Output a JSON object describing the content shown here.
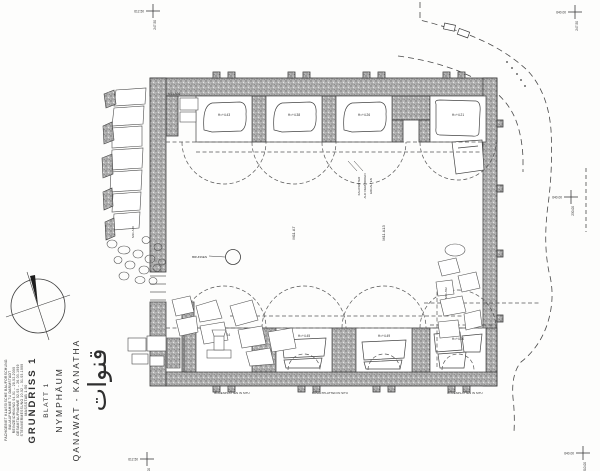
{
  "sheet": {
    "title_ar": "قنوات",
    "site": "QANAWAT - KANATHA",
    "building": "NYMPHÄUM",
    "sheet_no": "BLATT 1",
    "drawing": "GRUNDRISS 1",
    "scale": "MASSSTAB 1:50",
    "credits": [
      "STEINVERMESSUNG 10.02 – 01.03.1999",
      "GESAMTAUFNAHME 02.03 – 26.03.1999",
      "REINZEICHNUNG 04.01 – 28.02.2000",
      "BAUAUFNAHME TU DARMSTADT",
      "FACHGEBIET KLASSISCHE BAUFORSCHUNG"
    ]
  },
  "plan": {
    "top_niche_labels": [
      "H=+4.43",
      "H=+4.38",
      "H=+4.26",
      "H=+4.21"
    ],
    "bottom_niche_labels": [
      "H=+4.34",
      "H=+4.45",
      "H=+4.49",
      "H=+4.30"
    ],
    "in_situ_labels": [
      "BODENPLATTEN IN SITU",
      "BASALTPLATTEN IN SITU",
      "BODENPLATTEN IN SITU"
    ],
    "room_labels": [
      "M11 A7",
      "M11 A13"
    ],
    "stone_labels": {
      "wall_block": "M11 A36",
      "left_block": "M11 A40",
      "right_block": "M11 A52"
    },
    "well_label": "BRUNNEN",
    "note_lines": [
      "KALKSINTER",
      "AUF DEM BODEN",
      "ERHALTEN"
    ]
  },
  "survey_crosses": [
    {
      "h": "612.50",
      "v": "247.50"
    },
    {
      "h": "640.00",
      "v": "247.50"
    },
    {
      "h": "640.00",
      "v": "230.00"
    },
    {
      "h": "640.00",
      "v": "210.00"
    },
    {
      "h": "612.50",
      "v": "210.00"
    }
  ],
  "colors": {
    "ink": "#2f2f2f",
    "wall_gray": "#b3b3b3",
    "dash": "#555555",
    "paper": "#fdfdfc"
  }
}
